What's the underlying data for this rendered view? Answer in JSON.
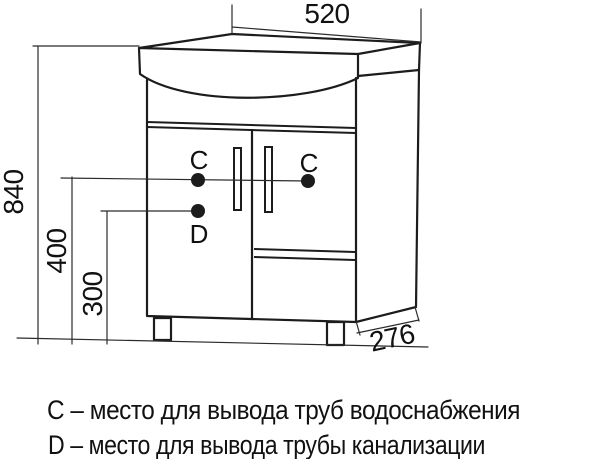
{
  "dimensions": {
    "top_width": "520",
    "overall_height": "840",
    "water_supply_height": "400",
    "drain_height": "300",
    "depth": "276"
  },
  "point_labels": {
    "c_left": "C",
    "c_right": "C",
    "d": "D"
  },
  "legend": {
    "line1": "C – место для вывода труб водоснабжения",
    "line2": "D – место для вывода трубы канализации"
  },
  "watermark": {
    "text": "21vek.by",
    "color": "#f4b8c5"
  },
  "colors": {
    "line": "#1c1c1c",
    "background": "#ffffff"
  }
}
